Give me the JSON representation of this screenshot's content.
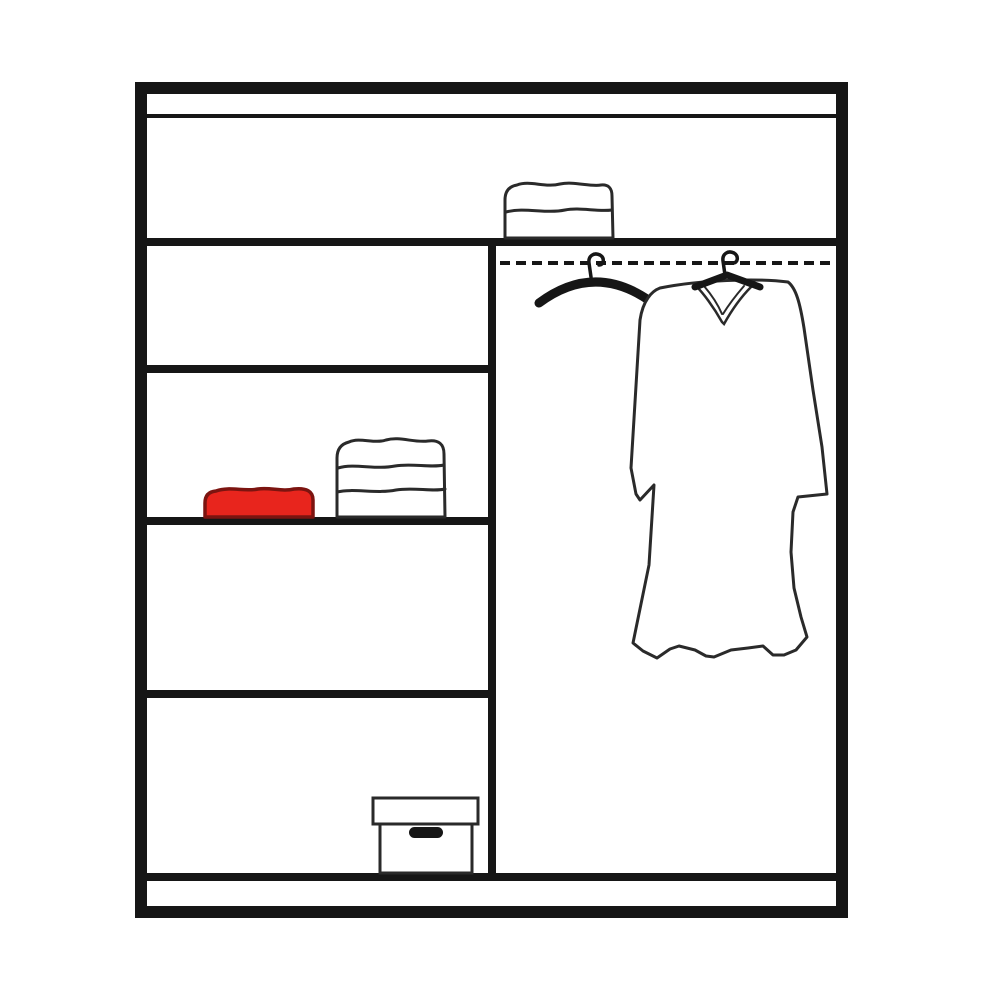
{
  "diagram": {
    "kind": "wardrobe-interior-line-diagram",
    "colors": {
      "surface": "#ffffff",
      "outline": "#161616",
      "outline_soft": "#2a2a2a",
      "red_item_fill": "#e8251d",
      "red_item_outline": "#7c1410"
    },
    "structure": {
      "full_width_top_shelf": true,
      "left_compartment_shelves": 3,
      "right_compartment": "hanging section with dashed rail",
      "bottom_plinth": true
    },
    "items": [
      {
        "name": "folded-towel-stack-2",
        "location": "on top shelf, center"
      },
      {
        "name": "red-folded-towel",
        "location": "left middle shelf"
      },
      {
        "name": "folded-towel-stack-3",
        "location": "left middle shelf"
      },
      {
        "name": "storage-box-with-lid",
        "location": "left bottom compartment"
      },
      {
        "name": "empty-hanger",
        "location": "hanging rail"
      },
      {
        "name": "garment-on-hanger",
        "location": "hanging rail"
      }
    ]
  }
}
